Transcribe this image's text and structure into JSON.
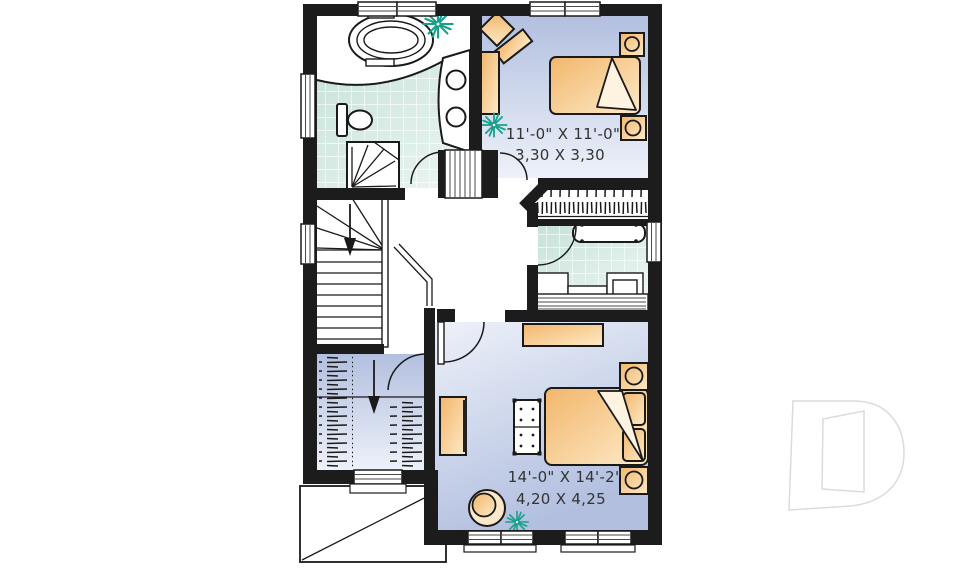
{
  "page": {
    "background": "#ffffff",
    "kind": "second-floor-plan"
  },
  "rooms": {
    "bedroom_top": {
      "dim_imperial": "11'-0\" X 11'-0\"",
      "dim_metric": "3,30 X 3,30"
    },
    "bedroom_bottom": {
      "dim_imperial": "14'-0\" X 14'-2\"",
      "dim_metric": "4,20 X 4,25"
    }
  },
  "fixtures": {
    "bathroom_main": [
      "bathtub-icon",
      "corner-shower-icon",
      "toilet-icon",
      "double-sink-vanity-icon",
      "plant-icon"
    ],
    "bedroom_top": [
      "desk-icon",
      "desk-chair-icon",
      "bed-icon",
      "nightstand-lamp-icon",
      "nightstand-lamp-icon",
      "plant-icon",
      "hanging-clothes-closet-icon"
    ],
    "hall": [
      "staircase-down-icon",
      "down-arrow-icon",
      "railing-icon",
      "door-swing-icon"
    ],
    "bathroom_ensuite": [
      "counter-icon",
      "vanity-icon",
      "bathtub-icon",
      "door-swing-icon"
    ],
    "walkin_closet": [
      "hanging-clothes-icon",
      "hanging-clothes-icon",
      "down-arrow-icon",
      "door-swing-icon"
    ],
    "bedroom_bottom": [
      "dresser-icon",
      "dresser-icon",
      "bed-icon",
      "bench-icon",
      "nightstand-lamp-icon",
      "nightstand-lamp-icon",
      "armchair-icon",
      "plant-icon"
    ],
    "exterior": [
      "porch-roof-outline"
    ]
  },
  "watermark": {
    "shape": "letter-D-outline"
  },
  "colors": {
    "wall": "#1c1c1c",
    "line": "#1a1a1a",
    "floor_blue_dark": "#b2bfdf",
    "floor_blue_light": "#edf1f9",
    "tile_dark": "#c6e2d8",
    "tile_light": "#ecf6f2",
    "furniture_dark": "#f2b66b",
    "furniture_light": "#fdeac8",
    "plant": "#17a08a",
    "watermark_outline": "#dbdbdb"
  }
}
